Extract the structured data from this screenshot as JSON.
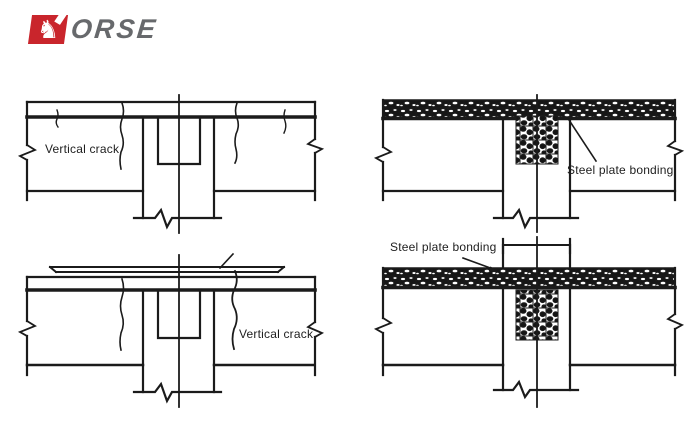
{
  "colors": {
    "background": "#ffffff",
    "line": "#1b1b1b",
    "logo_red": "#c9252c",
    "logo_gray": "#67696c",
    "label_text": "#1e1e1e"
  },
  "logo": {
    "brand": "HORSE",
    "brand_suffix": "ORSE",
    "horse_icon": "♞"
  },
  "diagrams": {
    "top_left": {
      "label": "Vertical crack"
    },
    "top_right": {
      "label": "Steel plate bonding"
    },
    "bottom_left": {
      "label": "Vertical crack"
    },
    "bottom_right": {
      "label": "Steel plate bonding"
    }
  }
}
